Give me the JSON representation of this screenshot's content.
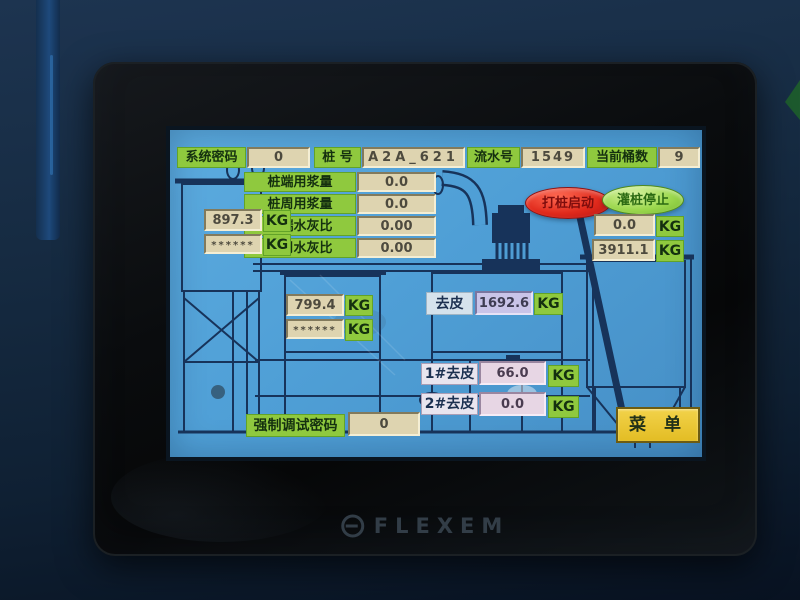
{
  "device": {
    "brand": "FLEXEM"
  },
  "units": {
    "kg": "KG"
  },
  "screen": {
    "top_bar": {
      "system_password_label": "系统密码",
      "system_password_value": "0",
      "pile_no_label": "桩 号",
      "pile_no_value": "A2A_621",
      "serial_no_label": "流水号",
      "serial_no_value": "1549",
      "bucket_count_label": "当前桶数",
      "bucket_count_value": "9"
    },
    "params": {
      "rows": [
        {
          "label": "桩端用浆量",
          "value": "0.0"
        },
        {
          "label": "桩周用浆量",
          "value": "0.0"
        },
        {
          "label": "桩端水灰比",
          "value": "0.00"
        },
        {
          "label": "桩周水灰比",
          "value": "0.00"
        }
      ]
    },
    "buttons": {
      "start": "打桩启动",
      "stop": "灌桩停止",
      "menu": "菜 单"
    },
    "weights": {
      "left_tank": {
        "gross": "897.3",
        "hidden": "******"
      },
      "mid_tank": {
        "gross": "799.4",
        "hidden": "******"
      },
      "right_hopper": {
        "current": "0.0",
        "total": "3911.1"
      },
      "tare": {
        "label": "去皮",
        "value": "1692.6"
      },
      "tare1": {
        "label": "1#去皮",
        "value": "66.0"
      },
      "tare2": {
        "label": "2#去皮",
        "value": "0.0"
      }
    },
    "debug": {
      "label": "强制调试密码",
      "value": "0"
    }
  }
}
